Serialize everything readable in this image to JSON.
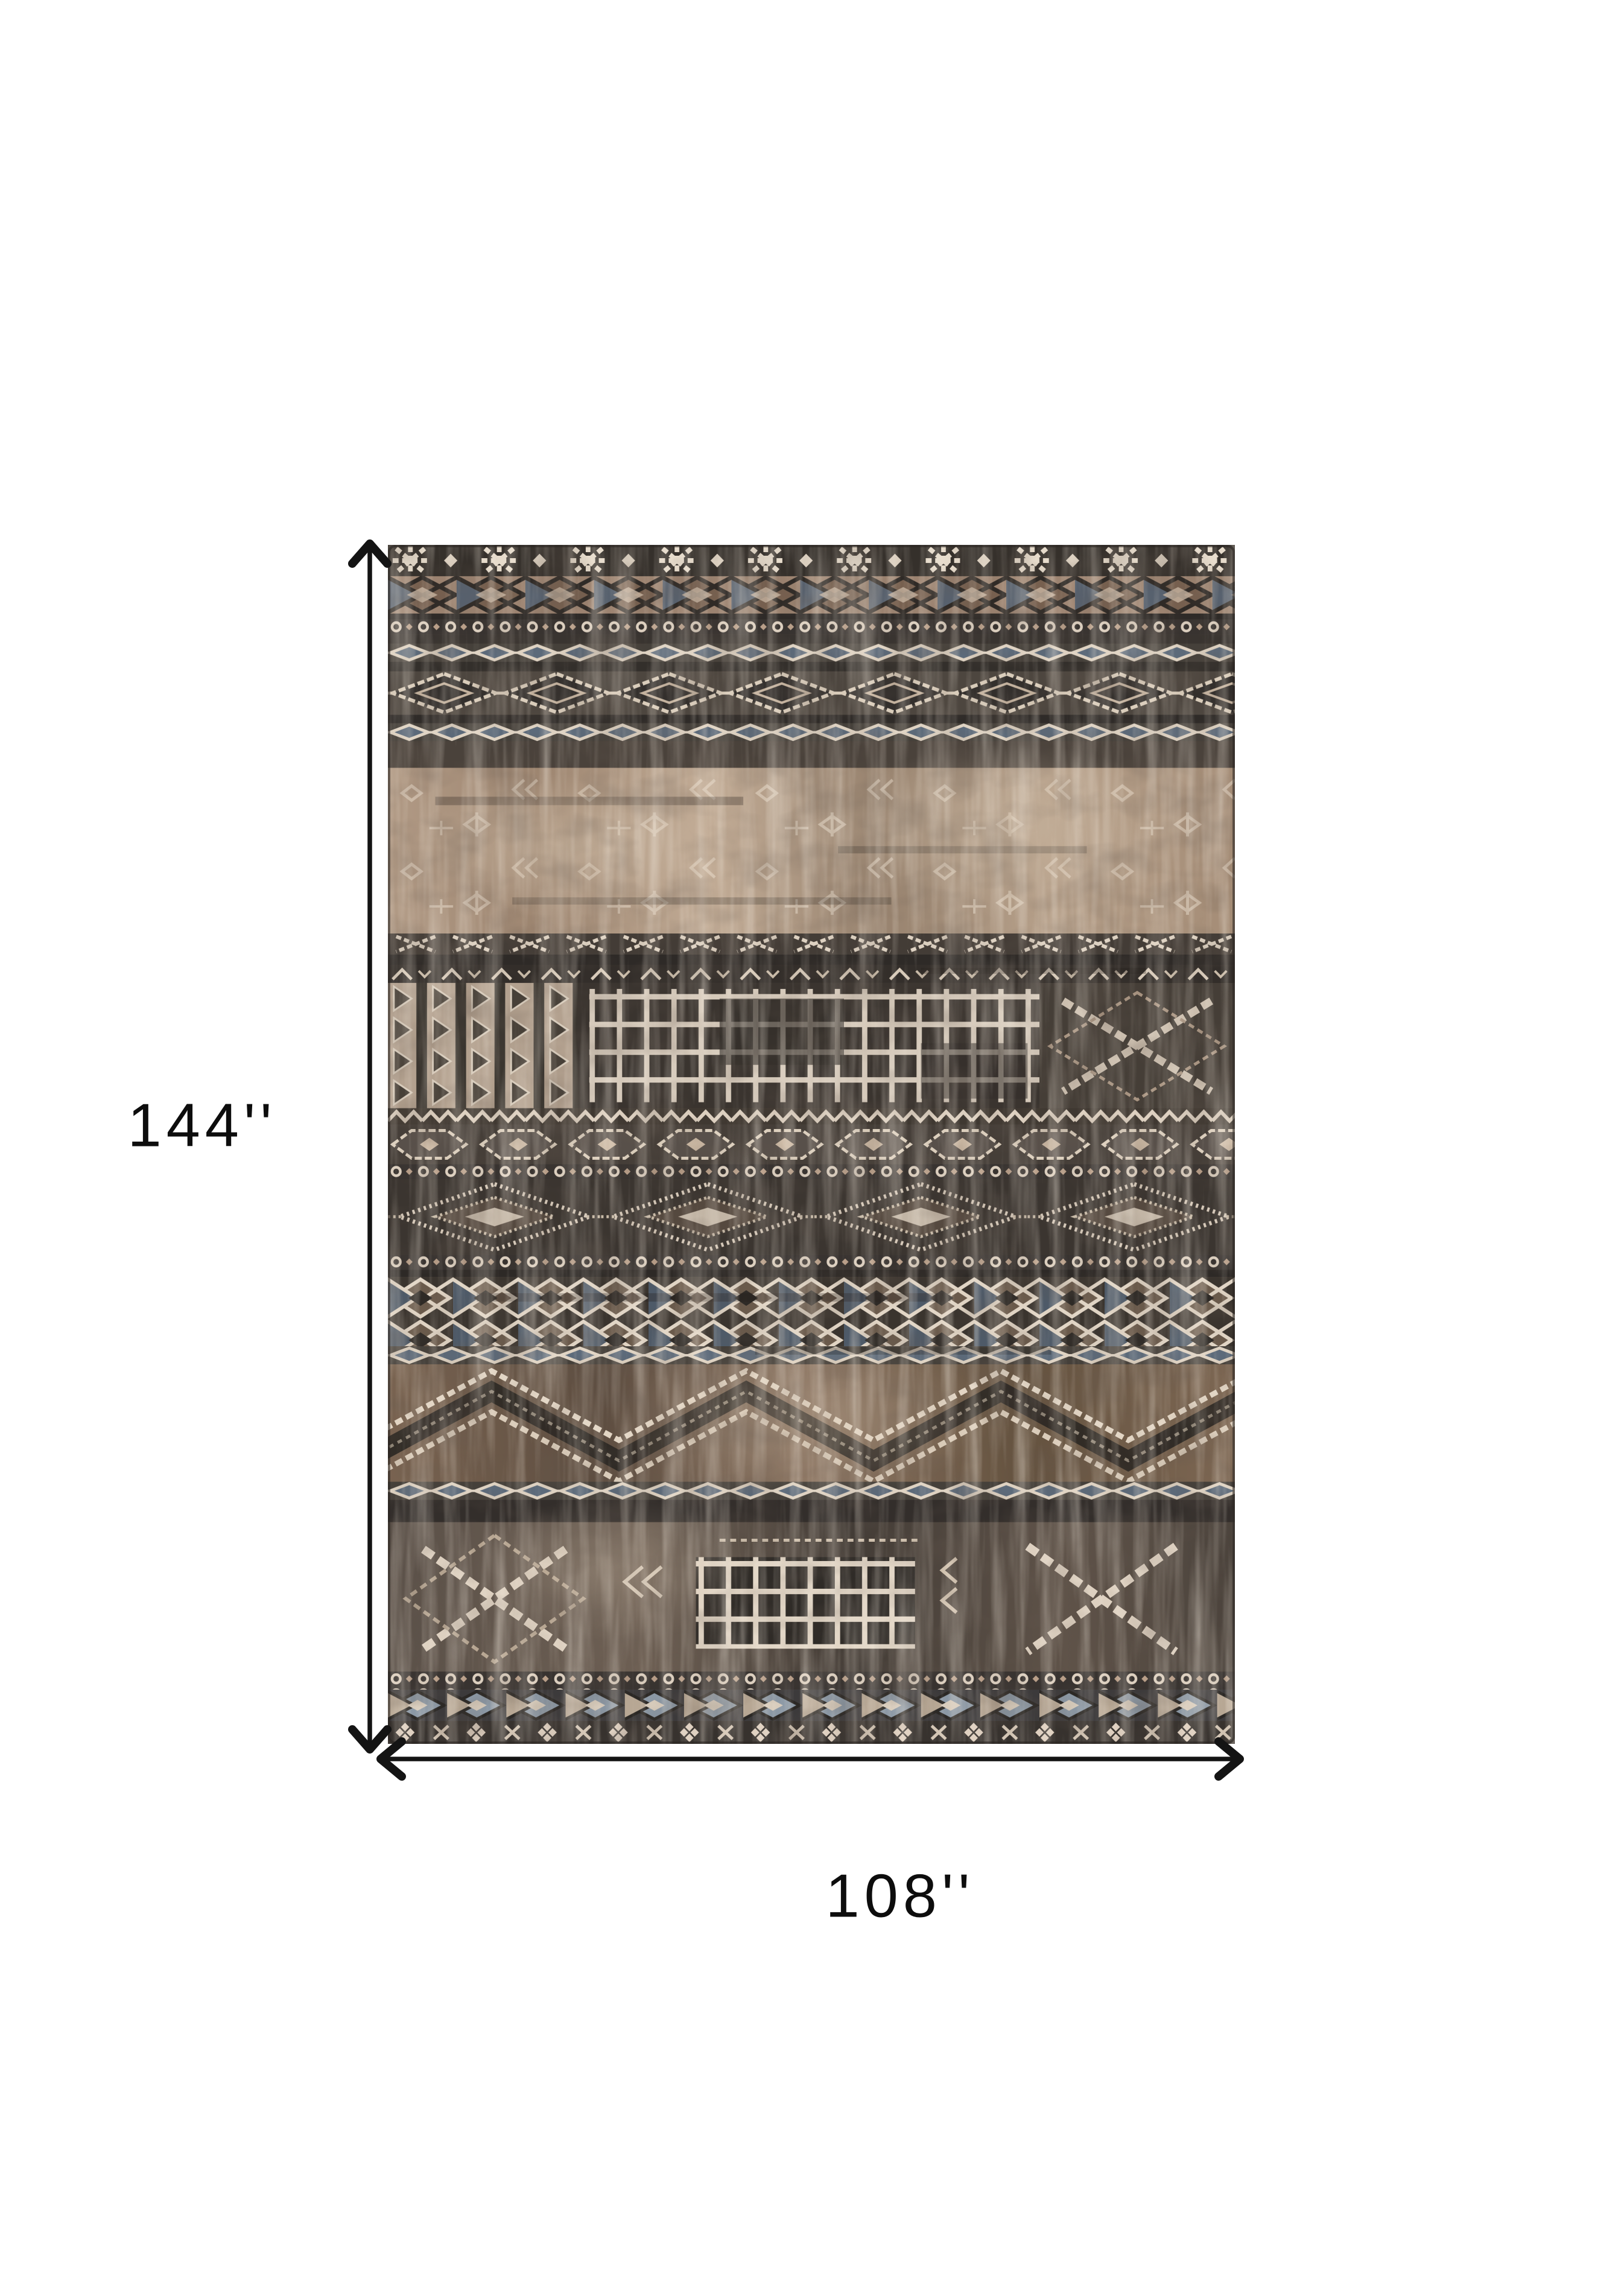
{
  "figure": {
    "height_label": "144''",
    "width_label": "108''"
  },
  "colors": {
    "background": "#ffffff",
    "line": "#141414",
    "label": "#0d0d0d"
  },
  "rug": {
    "description": "distressed brown, charcoal and cream tribal kilim pattern area rug shown flat",
    "palette": {
      "charcoal": "#38322d",
      "dark_brown": "#4a423b",
      "brown": "#6b5443",
      "tan": "#a68c76",
      "cream": "#e4d8c8",
      "slate_blue": "#5c6a7a",
      "rust": "#744c32"
    }
  }
}
